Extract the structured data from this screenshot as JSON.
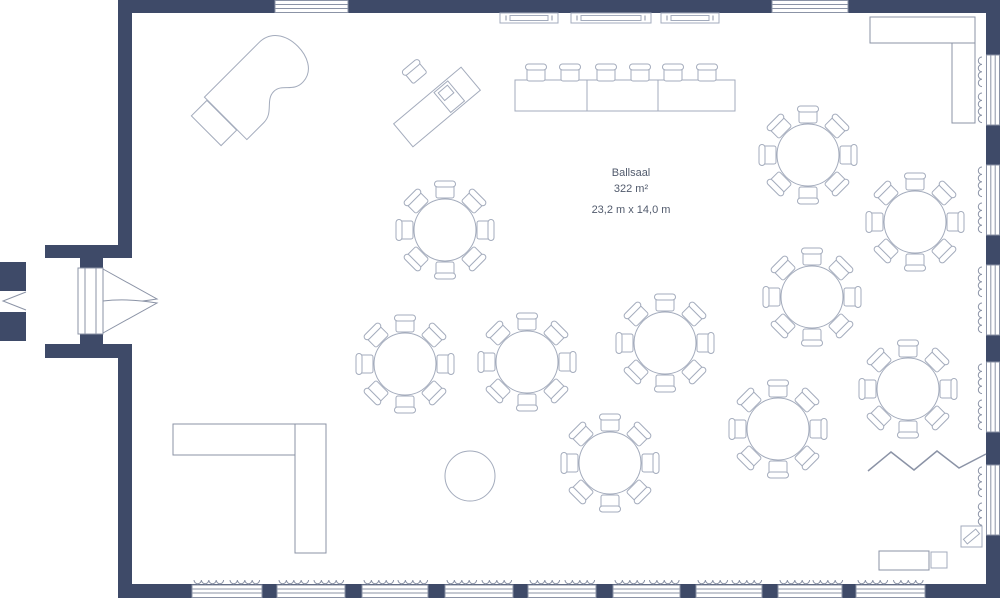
{
  "room": {
    "name": "Ballsaal",
    "area": "322 m²",
    "dimensions": "23,2 m x 14,0 m"
  },
  "colors": {
    "wall": "#3e4a68",
    "stroke": "#a3abbc",
    "stroke_dark": "#8b93a6",
    "text": "#525b6d",
    "background": "#ffffff"
  },
  "structure": {
    "wall_rects": [
      {
        "name": "wall-top",
        "x": 118,
        "y": 0,
        "w": 882,
        "h": 13
      },
      {
        "name": "wall-right",
        "x": 986,
        "y": 0,
        "w": 14,
        "h": 598
      },
      {
        "name": "wall-bottom",
        "x": 118,
        "y": 584,
        "w": 882,
        "h": 14
      },
      {
        "name": "wall-left-upper",
        "x": 118,
        "y": 0,
        "w": 14,
        "h": 245
      },
      {
        "name": "wall-left-lower",
        "x": 118,
        "y": 358,
        "w": 14,
        "h": 240
      },
      {
        "name": "alcove-wall-top",
        "x": 45,
        "y": 245,
        "w": 87,
        "h": 13
      },
      {
        "name": "alcove-wall-bottom",
        "x": 45,
        "y": 344,
        "w": 87,
        "h": 14
      },
      {
        "name": "door-jamb-top",
        "x": 80,
        "y": 258,
        "w": 23,
        "h": 10
      },
      {
        "name": "door-jamb-bottom",
        "x": 80,
        "y": 334,
        "w": 23,
        "h": 10
      },
      {
        "name": "exterior-stub-top",
        "x": 0,
        "y": 262,
        "w": 26,
        "h": 29
      },
      {
        "name": "exterior-stub-bottom",
        "x": 0,
        "y": 312,
        "w": 26,
        "h": 29
      }
    ],
    "windows_top": [
      {
        "x": 275,
        "w": 73
      },
      {
        "x": 772,
        "w": 76
      }
    ],
    "windows_right": [
      {
        "y": 55,
        "h": 70
      },
      {
        "y": 165,
        "h": 70
      },
      {
        "y": 265,
        "h": 70
      },
      {
        "y": 362,
        "h": 70
      },
      {
        "y": 465,
        "h": 70
      }
    ],
    "windows_bottom": [
      {
        "x": 192,
        "w": 70
      },
      {
        "x": 277,
        "w": 68
      },
      {
        "x": 362,
        "w": 66
      },
      {
        "x": 445,
        "w": 68
      },
      {
        "x": 528,
        "w": 68
      },
      {
        "x": 613,
        "w": 67
      },
      {
        "x": 696,
        "w": 66
      },
      {
        "x": 778,
        "w": 64
      },
      {
        "x": 856,
        "w": 69
      }
    ],
    "door": {
      "frame_x": 78,
      "frame_y": 268,
      "frame_w": 25,
      "frame_h": 66,
      "leaf_top": "M 103 269 L 157 299 Q 127 304 103 301 Z",
      "leaf_bottom": "M 103 333 L 157 303 Q 127 298 103 301 Z"
    },
    "exterior_chevron": "26,292 3,301 26,310"
  },
  "furniture": {
    "round_tables": {
      "radius": 31,
      "seats": 8,
      "chair_distance": 40,
      "centers": [
        [
          445,
          230
        ],
        [
          808,
          155
        ],
        [
          915,
          222
        ],
        [
          812,
          297
        ],
        [
          665,
          343
        ],
        [
          405,
          364
        ],
        [
          527,
          362
        ],
        [
          908,
          389
        ],
        [
          778,
          429
        ],
        [
          610,
          463
        ]
      ]
    },
    "cocktail_table": {
      "cx": 470,
      "cy": 476,
      "r": 25
    },
    "head_tables": [
      [
        515,
        80,
        72,
        31
      ],
      [
        587,
        80,
        71,
        31
      ],
      [
        658,
        80,
        77,
        31
      ]
    ],
    "head_chairs_x": [
      536,
      570,
      606,
      640,
      673,
      707
    ],
    "head_chairs_y": 73,
    "sideboards": [
      [
        500,
        13,
        58,
        10
      ],
      [
        571,
        13,
        80,
        10
      ],
      [
        661,
        13,
        58,
        10
      ]
    ],
    "counter_top_right": [
      [
        870,
        17,
        105,
        26
      ],
      [
        952,
        43,
        23,
        80
      ]
    ],
    "bar_bottom_left": [
      [
        173,
        424,
        122,
        31
      ],
      [
        295,
        424,
        31,
        129
      ]
    ],
    "piano": {
      "cx": 261,
      "cy": 83,
      "rotate": 45,
      "path": "M -30 50 L 30 50 L 30 26 C 30 12 15 9 15 -3 C 15 -15 30 -16 29 -31 C 28 -46 13 -52 0 -52 C -17 -52 -30 -43 -30 -27 Z"
    },
    "piano_bench": {
      "cx": 214,
      "cy": 123,
      "rotate": 45,
      "w": 42,
      "h": 22
    },
    "desk": {
      "cx": 437,
      "cy": 107,
      "rotate": -40,
      "w": 88,
      "h": 30
    },
    "desk_chair": {
      "x": 415,
      "y": 72,
      "rotate": 140
    },
    "divider_zigzag": "868,471 891,452 914,470 937,451 959,468 986,454",
    "wall_speaker": {
      "x": 961,
      "y": 526,
      "w": 21,
      "h": 21
    },
    "service_table": {
      "x": 879,
      "y": 551,
      "w": 50,
      "h": 19
    },
    "service_cart": {
      "x": 931,
      "y": 552,
      "w": 16,
      "h": 16
    }
  }
}
